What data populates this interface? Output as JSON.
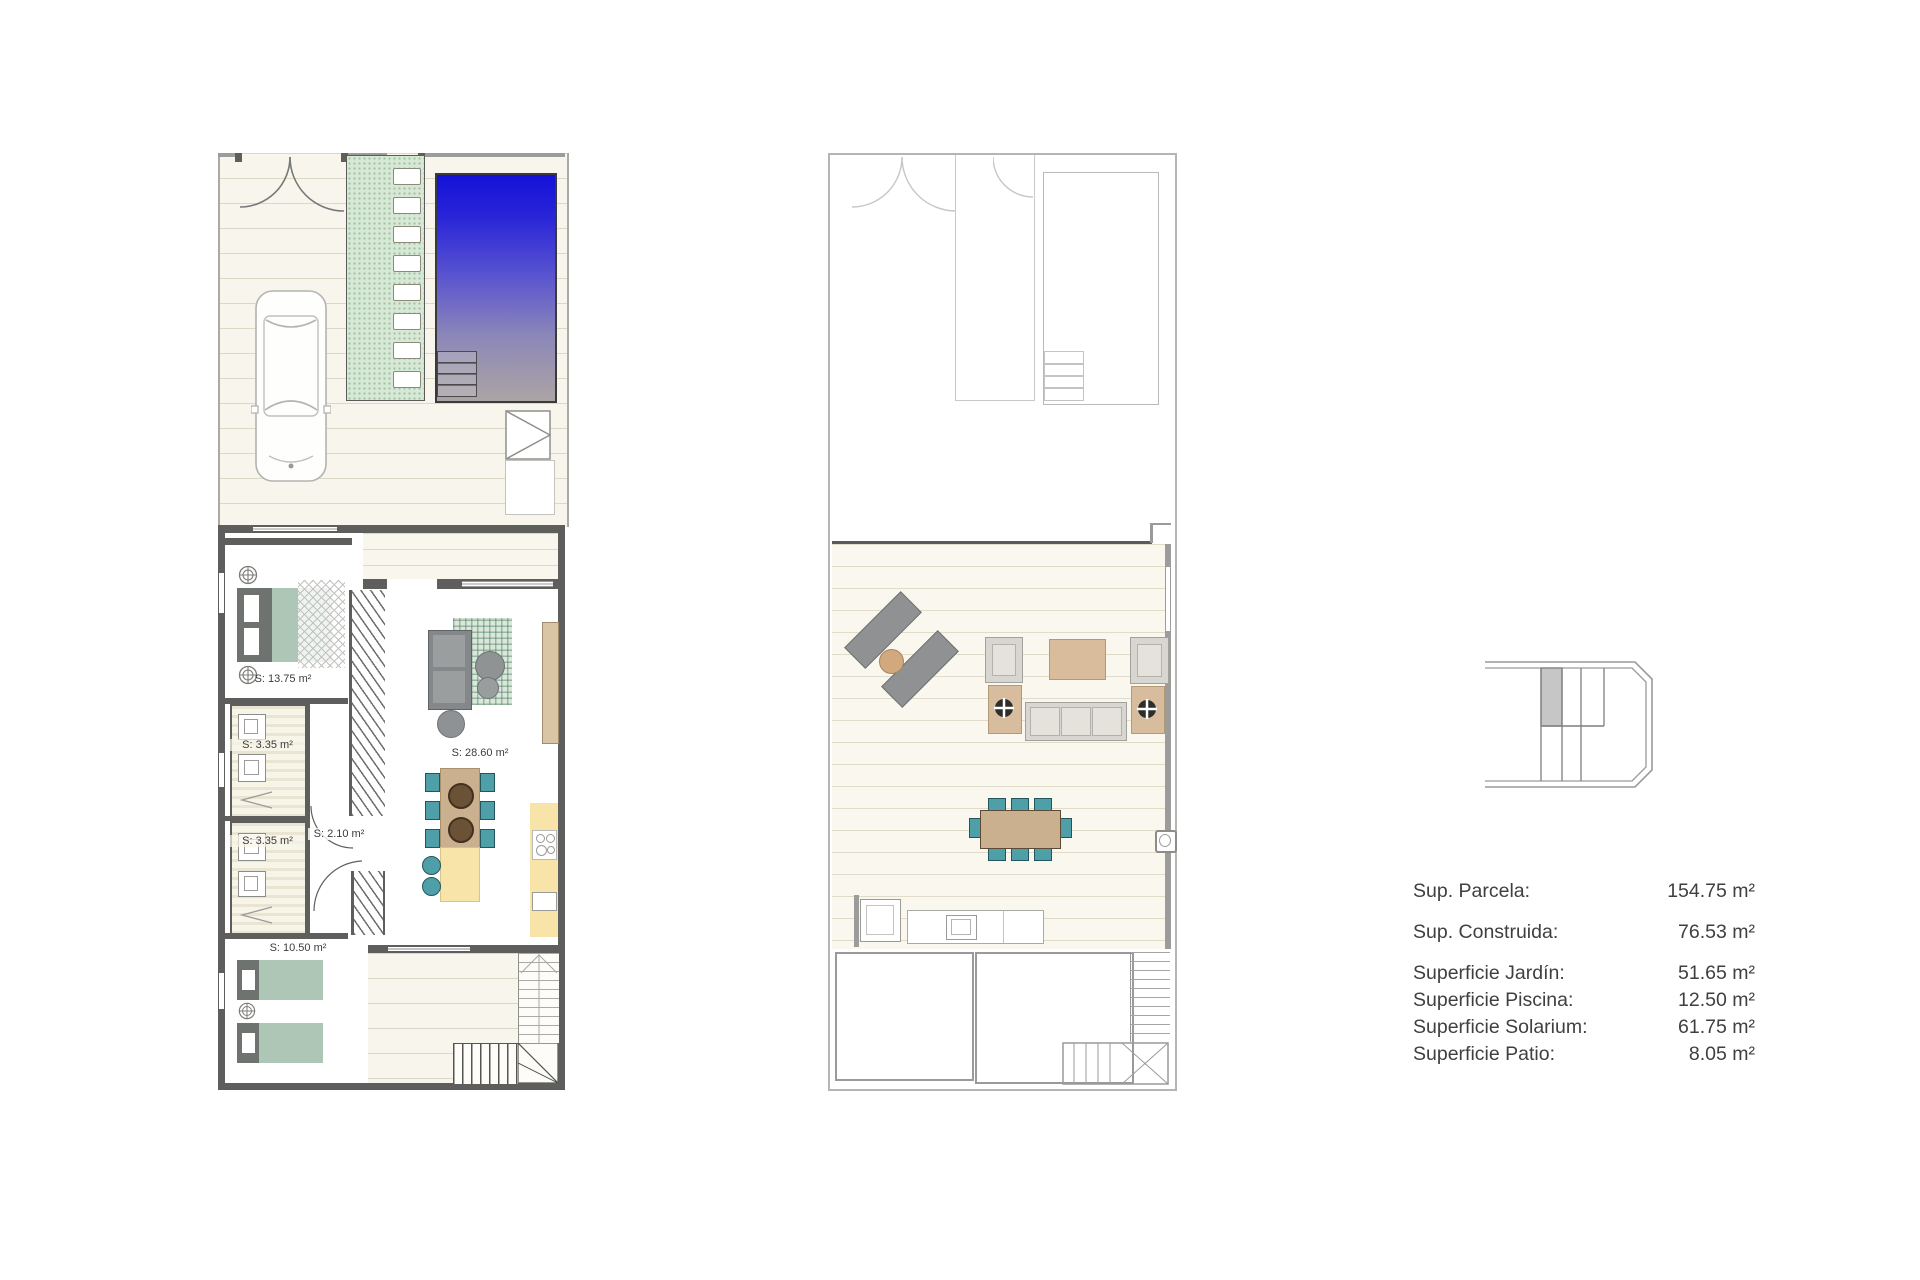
{
  "ground_floor": {
    "rooms": {
      "bedroom_main": "S: 13.75 m²",
      "bathroom_1": "S: 3.35 m²",
      "hall": "S: 2.10 m²",
      "bathroom_2": "S: 3.35 m²",
      "bedroom_second": "S: 10.50 m²",
      "living_kitchen": "S: 28.60 m²"
    }
  },
  "legend": {
    "rows": [
      {
        "label": "Sup. Parcela:",
        "value": "154.75 m²"
      },
      {
        "label": "Sup. Construida:",
        "value": "76.53 m²"
      },
      {
        "label": "Superficie Jardín:",
        "value": "51.65 m²"
      },
      {
        "label": "Superficie Piscina:",
        "value": "12.50 m²"
      },
      {
        "label": "Superficie Solarium:",
        "value": "61.75 m²"
      },
      {
        "label": "Superficie Patio:",
        "value": "8.05 m²"
      }
    ]
  },
  "icons": {
    "wall_lamp": "crosshair-circle",
    "parasol_base": "crosshair-circle",
    "car": "top-view-car-outline",
    "outdoor_shower": "rect-with-triangle",
    "drain": "square-with-circle",
    "stove": "four-burner-circles",
    "sink": "double-rect"
  },
  "colors": {
    "pool_top": "#1512d8",
    "pool_bottom": "#aba4a4",
    "path_green": "#d8e8d6",
    "accent_teal": "#4f9fa8",
    "wood_tan": "#d9bc9b",
    "kitchen_yellow": "#f8e4a9",
    "bed_sage": "#aec6b6",
    "wall_gray": "#5e5f5d"
  }
}
